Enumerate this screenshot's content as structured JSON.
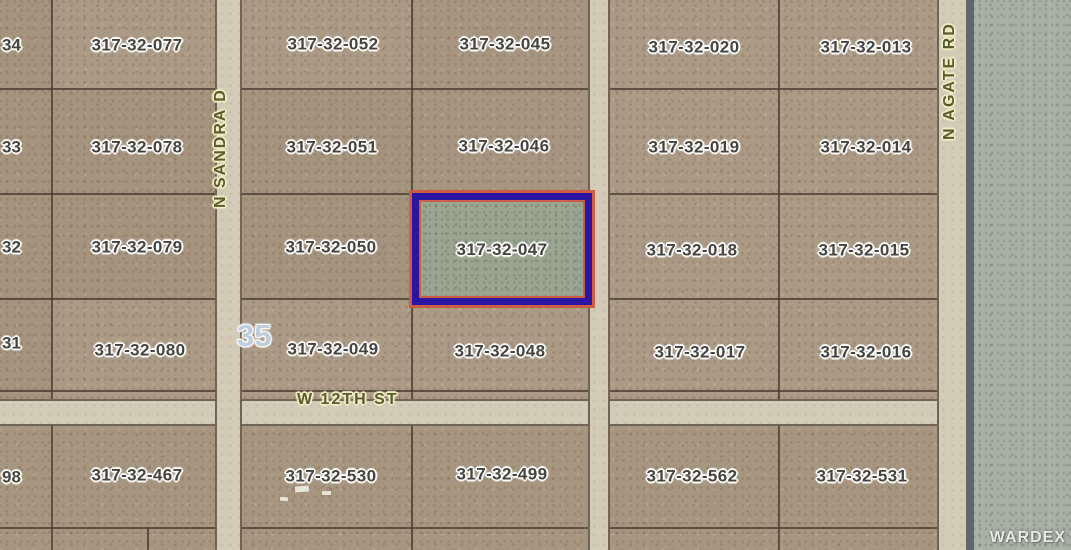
{
  "map": {
    "section_number": "35",
    "watermark": "WARDEX",
    "streets": {
      "vertical_left": "N SANDRA D",
      "vertical_right": "N AGATE RD",
      "horizontal": "W 12TH ST"
    },
    "highlight": {
      "parcel": "317-32-047",
      "border_main_color": "#2b16a4",
      "border_accent_color": "#cd5c44",
      "fill_color": "#9aa691"
    },
    "parcels": {
      "partial_left": [
        "34",
        "33",
        "32",
        "31",
        "98"
      ],
      "grid": [
        [
          "317-32-077",
          "317-32-052",
          "317-32-045",
          "317-32-020",
          "317-32-013"
        ],
        [
          "317-32-078",
          "317-32-051",
          "317-32-046",
          "317-32-019",
          "317-32-014"
        ],
        [
          "317-32-079",
          "317-32-050",
          "317-32-047",
          "317-32-018",
          "317-32-015"
        ],
        [
          "317-32-080",
          "317-32-049",
          "317-32-048",
          "317-32-017",
          "317-32-016"
        ],
        [
          "317-32-467",
          "317-32-530",
          "317-32-499",
          "317-32-562",
          "317-32-531"
        ]
      ]
    },
    "colors": {
      "land": "#ab9a85",
      "terrain_right": "#a8b1a3",
      "road_fill": "#d3cab8",
      "road_edge": "#6e6557",
      "parcel_line": "#5f584b",
      "label_text": "#45433d",
      "street_text": "#585c2d",
      "section_text": "#becddb"
    }
  }
}
